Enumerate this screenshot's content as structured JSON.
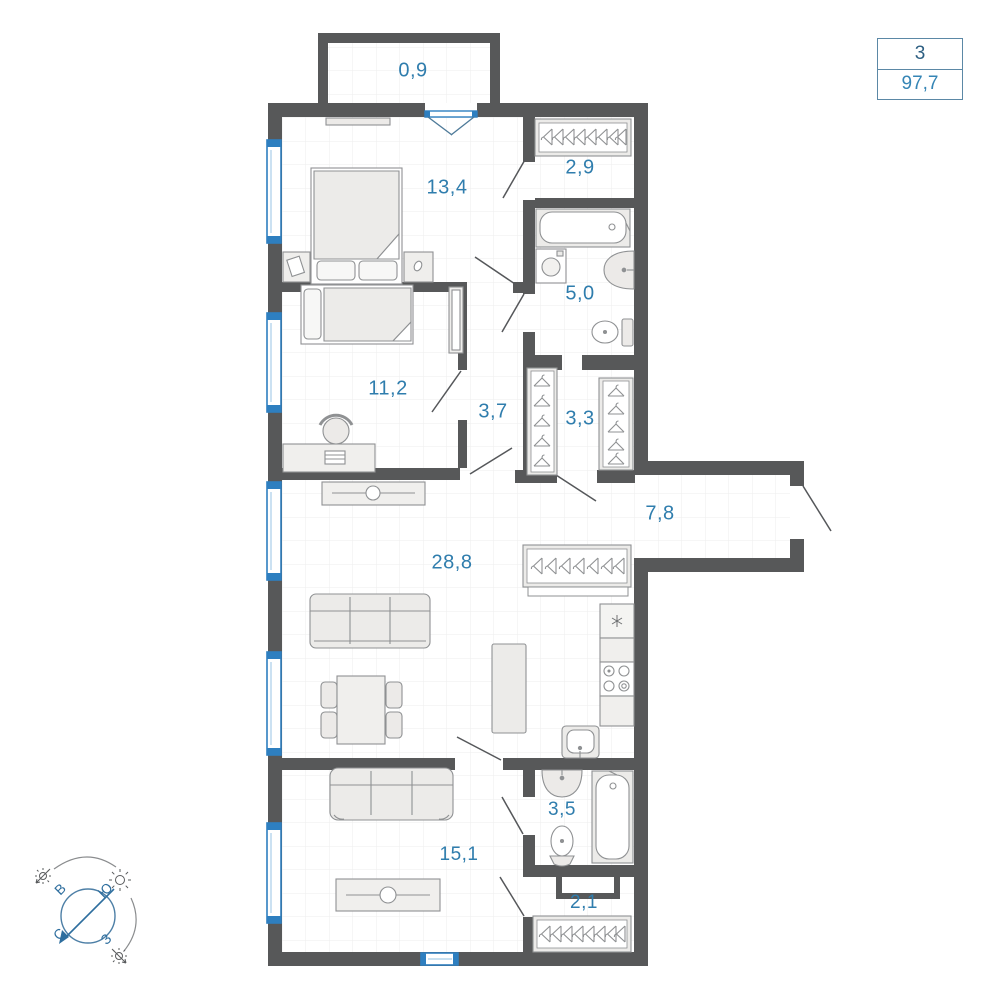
{
  "badge": {
    "top_value": "3",
    "bottom_value": "97,7"
  },
  "rooms": [
    {
      "id": "balcony",
      "area": "0,9"
    },
    {
      "id": "bedroom-1",
      "area": "13,4"
    },
    {
      "id": "wardrobe-1",
      "area": "2,9"
    },
    {
      "id": "bathroom-1",
      "area": "5,0"
    },
    {
      "id": "bedroom-2",
      "area": "11,2"
    },
    {
      "id": "hallway",
      "area": "3,7"
    },
    {
      "id": "closet",
      "area": "3,3"
    },
    {
      "id": "corridor",
      "area": "7,8"
    },
    {
      "id": "living-kitchen",
      "area": "28,8"
    },
    {
      "id": "bathroom-2",
      "area": "3,5"
    },
    {
      "id": "living-room",
      "area": "15,1"
    },
    {
      "id": "wardrobe-2",
      "area": "2,1"
    }
  ],
  "compass": {
    "north": "С",
    "east": "В",
    "south": "Ю",
    "west": "З"
  },
  "colors": {
    "wall": "#575859",
    "label_blue": "#2f7dad",
    "window_blue": "#2e7fc0",
    "badge_border": "#5b88a6",
    "furniture_stroke": "#8f9193",
    "grid": "#ededed"
  },
  "icons": {
    "hanger": "clothes-hanger glyph",
    "snowflake": "fridge asterisk",
    "sun": "sunrise/sunset sun",
    "compass": "rotated N-E-S-W rose"
  }
}
